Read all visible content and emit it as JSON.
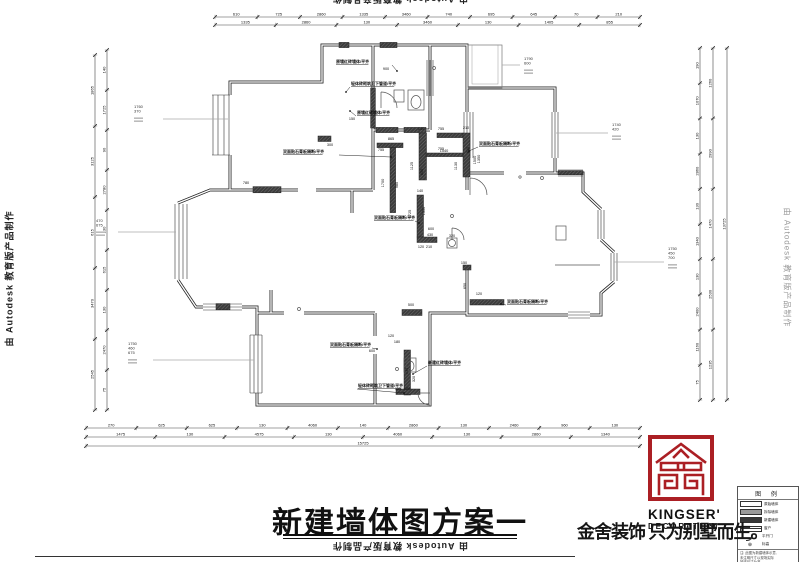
{
  "colors": {
    "accent_red": "#ab1f24",
    "line": "#2a2a2a",
    "ref_gray": "#aaaaaa"
  },
  "watermark": {
    "text": "由 Autodesk 教育版产品制作"
  },
  "title_block": {
    "title": "新建墙体图方案一",
    "slogan": "金舍装饰 只为别墅而生。",
    "logo_name": "KINGSER'",
    "logo_sub": "DECORATION"
  },
  "legend": {
    "header": "图 例",
    "rows": [
      {
        "label": "原始墙体"
      },
      {
        "label": "拆除墙体"
      },
      {
        "label": "新建墙体"
      },
      {
        "label": "窗户"
      },
      {
        "label": "平开门"
      },
      {
        "label": "标高"
      }
    ],
    "note_lines": [
      "注: 此图为新建墙体示意,",
      "未注明尺寸以现场实际",
      "放线尺寸为准。"
    ]
  },
  "annotations": [
    {
      "t": "原墙红砖墙体/平齐",
      "x": 336,
      "y": 63,
      "p": [
        392,
        65,
        397,
        71
      ]
    },
    {
      "t": "轻体砖砌筑卫下管道/平齐",
      "x": 351,
      "y": 85,
      "p": [
        350,
        87,
        346,
        92
      ]
    },
    {
      "t": "原墙红砖墙体/平齐",
      "x": 357,
      "y": 114,
      "p": [
        356,
        116,
        350,
        111
      ]
    },
    {
      "t": "双面贴石膏板隔断/平齐",
      "x": 283,
      "y": 153,
      "p": [
        339,
        155,
        391,
        157
      ]
    },
    {
      "t": "双面贴石膏板隔断/平齐",
      "x": 479,
      "y": 145,
      "p": [
        478,
        147,
        469,
        151
      ]
    },
    {
      "t": "双面贴石膏板隔断/平齐",
      "x": 374,
      "y": 219,
      "p": [
        415,
        221,
        419,
        223
      ]
    },
    {
      "t": "双面贴石膏板隔断/平齐",
      "x": 507,
      "y": 303,
      "p": [
        506,
        305,
        501,
        304
      ]
    },
    {
      "t": "新建红砖墙体/平齐",
      "x": 428,
      "y": 364,
      "p": [
        427,
        366,
        413,
        374
      ]
    },
    {
      "t": "轻体砖砌筑卫下管道/平齐",
      "x": 358,
      "y": 387,
      "p": [
        357,
        389,
        404,
        393
      ]
    },
    {
      "t": "双面贴石膏板隔断/平齐",
      "x": 330,
      "y": 346,
      "p": [
        372,
        348,
        377,
        349
      ]
    }
  ],
  "plan_dims": [
    {
      "t": "900",
      "x": 386,
      "y": 70
    },
    {
      "t": "300",
      "x": 330,
      "y": 146
    },
    {
      "t": "150",
      "x": 352,
      "y": 120
    },
    {
      "t": "865",
      "x": 391,
      "y": 140
    },
    {
      "t": "755",
      "x": 381,
      "y": 151
    },
    {
      "t": "755",
      "x": 441,
      "y": 130
    },
    {
      "t": "210",
      "x": 466,
      "y": 129
    },
    {
      "t": "755",
      "x": 441,
      "y": 150
    },
    {
      "t": "1130",
      "x": 457,
      "y": 166,
      "r": 1
    },
    {
      "t": "1500",
      "x": 476,
      "y": 160,
      "r": 1
    },
    {
      "t": "1700",
      "x": 384,
      "y": 183,
      "r": 1
    },
    {
      "t": "980",
      "x": 398,
      "y": 185,
      "r": 1
    },
    {
      "t": "140",
      "x": 421,
      "y": 130
    },
    {
      "t": "1540",
      "x": 444,
      "y": 152
    },
    {
      "t": "1125",
      "x": 413,
      "y": 166,
      "r": 1
    },
    {
      "t": "650",
      "x": 423,
      "y": 172,
      "r": 1
    },
    {
      "t": "810",
      "x": 469,
      "y": 150,
      "r": 1
    },
    {
      "t": "1350",
      "x": 480,
      "y": 159,
      "r": 1
    },
    {
      "t": "140",
      "x": 420,
      "y": 192
    },
    {
      "t": "1725",
      "x": 411,
      "y": 214,
      "r": 1
    },
    {
      "t": "1350",
      "x": 425,
      "y": 211,
      "r": 1
    },
    {
      "t": "600",
      "x": 431,
      "y": 230
    },
    {
      "t": "430",
      "x": 430,
      "y": 236
    },
    {
      "t": "320",
      "x": 452,
      "y": 237
    },
    {
      "t": "120",
      "x": 421,
      "y": 248
    },
    {
      "t": "210",
      "x": 429,
      "y": 248
    },
    {
      "t": "780",
      "x": 246,
      "y": 184
    },
    {
      "t": "500",
      "x": 411,
      "y": 306
    },
    {
      "t": "120",
      "x": 479,
      "y": 295
    },
    {
      "t": "650",
      "x": 466,
      "y": 286,
      "r": 1
    },
    {
      "t": "600",
      "x": 372,
      "y": 352
    },
    {
      "t": "120",
      "x": 391,
      "y": 337
    },
    {
      "t": "180",
      "x": 397,
      "y": 343
    },
    {
      "t": "430",
      "x": 408,
      "y": 371,
      "r": 1
    },
    {
      "t": "320",
      "x": 415,
      "y": 379,
      "r": 1
    },
    {
      "t": "150",
      "x": 398,
      "y": 390
    },
    {
      "t": "120",
      "x": 407,
      "y": 390
    },
    {
      "t": "150",
      "x": 464,
      "y": 264
    }
  ],
  "ref_annotations": [
    {
      "vals": [
        "1790",
        "600"
      ],
      "x": 524,
      "y": 60,
      "line": [
        502,
        65,
        520,
        65
      ]
    },
    {
      "vals": [
        "1740",
        "420"
      ],
      "x": 612,
      "y": 126,
      "line": [
        556,
        133,
        608,
        133
      ]
    },
    {
      "vals": [
        "1750",
        "450",
        "700"
      ],
      "x": 668,
      "y": 250,
      "line": [
        614,
        262,
        664,
        262
      ]
    },
    {
      "vals": [
        "1760",
        "370"
      ],
      "x": 134,
      "y": 108,
      "line": [
        163,
        119,
        228,
        119
      ]
    },
    {
      "vals": [
        "470",
        "675"
      ],
      "x": 96,
      "y": 222,
      "line": [
        118,
        232,
        176,
        232
      ]
    },
    {
      "vals": [
        "1750",
        "460",
        "675"
      ],
      "x": 128,
      "y": 345,
      "line": [
        153,
        360,
        254,
        360
      ]
    }
  ],
  "rulers": [
    {
      "o": "h",
      "a": 215,
      "b": 640,
      "c": 17,
      "vals": [
        "610",
        "725",
        "2860",
        "1335",
        "3460",
        "740",
        "695",
        "645",
        "70",
        "210"
      ]
    },
    {
      "o": "h",
      "a": 215,
      "b": 640,
      "c": 25,
      "vals": [
        "1335",
        "2860",
        "130",
        "3460",
        "130",
        "1405",
        "855"
      ]
    },
    {
      "o": "h",
      "a": 86,
      "b": 640,
      "c": 428,
      "vals": [
        "270",
        "625",
        "625",
        "130",
        "4060",
        "140",
        "2860",
        "130",
        "2460",
        "960",
        "130"
      ]
    },
    {
      "o": "h",
      "a": 86,
      "b": 640,
      "c": 437,
      "vals": [
        "1475",
        "130",
        "4575",
        "130",
        "4060",
        "130",
        "2860",
        "1340"
      ]
    },
    {
      "o": "h",
      "a": 86,
      "b": 640,
      "c": 446,
      "vals": [
        "15725"
      ]
    },
    {
      "o": "v",
      "a": 55,
      "b": 410,
      "c": 95,
      "vals": [
        "1865",
        "3125",
        "615",
        "3470",
        "2545"
      ]
    },
    {
      "o": "v",
      "a": 50,
      "b": 410,
      "c": 107,
      "vals": [
        "140",
        "1725",
        "90",
        "2780",
        "130",
        "615",
        "130",
        "2470",
        "75"
      ]
    },
    {
      "o": "v",
      "a": 48,
      "b": 400,
      "c": 700,
      "vals": [
        "190",
        "1070",
        "130",
        "2860",
        "130",
        "1340",
        "130",
        "2400",
        "1160",
        "75"
      ]
    },
    {
      "o": "v",
      "a": 48,
      "b": 400,
      "c": 713,
      "vals": [
        "1260",
        "2990",
        "1470",
        "2530",
        "1235"
      ]
    },
    {
      "o": "v",
      "a": 48,
      "b": 400,
      "c": 727,
      "vals": [
        "13725"
      ]
    }
  ]
}
